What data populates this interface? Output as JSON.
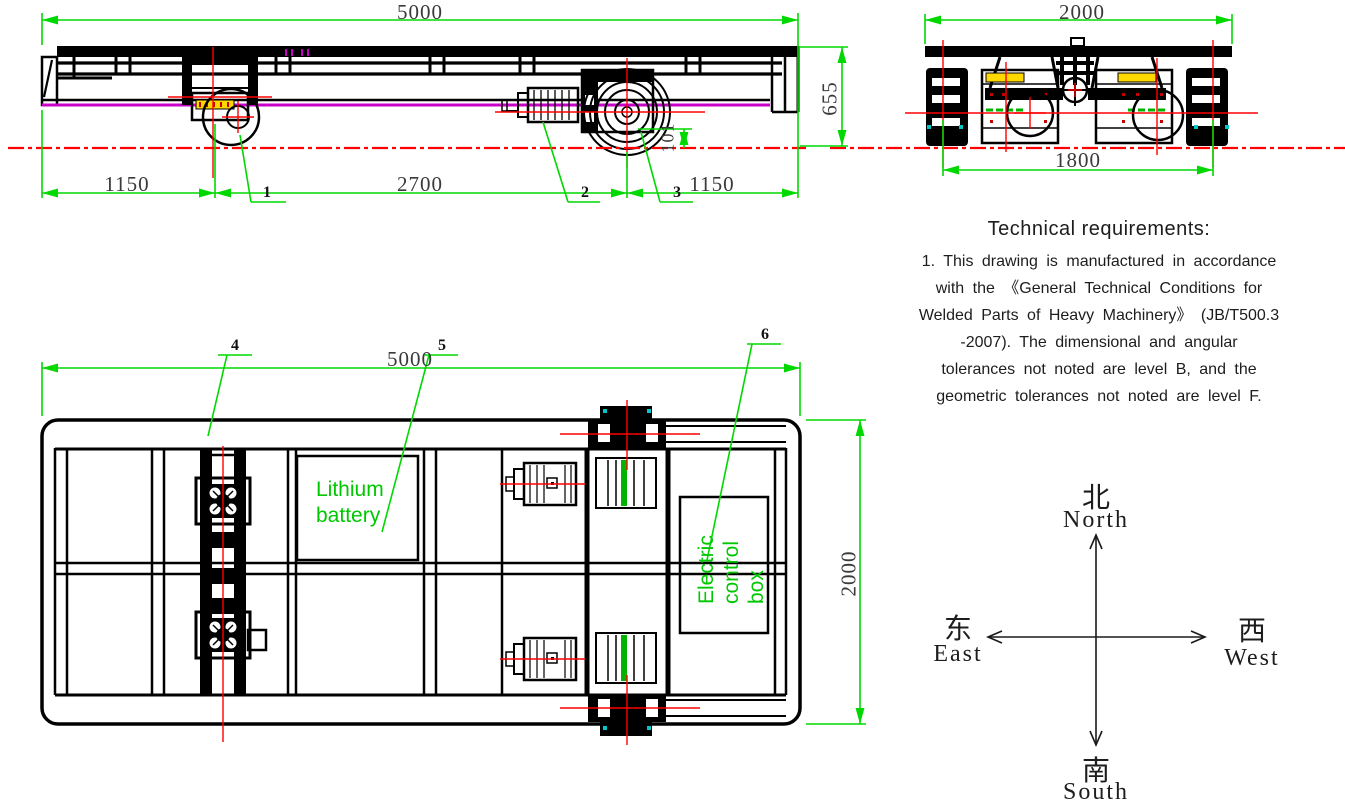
{
  "side_view": {
    "dim_total": "5000",
    "dim_left": "1150",
    "dim_center": "2700",
    "dim_right": "1150",
    "dim_height": "655",
    "dim_wheel_rail": "101",
    "callout_1": "1",
    "callout_2": "2",
    "callout_3": "3"
  },
  "end_view": {
    "dim_width": "2000",
    "dim_gauge": "1800"
  },
  "plan_view": {
    "dim_length": "5000",
    "dim_width": "2000",
    "callout_4": "4",
    "callout_5": "5",
    "callout_6": "6",
    "battery_line1": "Lithium",
    "battery_line2": "battery",
    "control_line1": "Electric",
    "control_line2": "control",
    "control_line3": "box"
  },
  "tech_requirements": {
    "title": "Technical requirements:",
    "lines": [
      "1. This drawing is manufactured in accordance",
      "with the 《General Technical Conditions for",
      "Welded Parts of Heavy Machinery》 (JB/T500.3",
      "-2007). The dimensional and angular",
      "tolerances not noted are level B, and the",
      "geometric tolerances not noted are level F."
    ]
  },
  "compass": {
    "north_cn": "北",
    "north_en": "North",
    "south_cn": "南",
    "south_en": "South",
    "east_cn": "东",
    "east_en": "East",
    "west_cn": "西",
    "west_en": "West"
  },
  "colors": {
    "dimension_green": "#00d800",
    "centerline_red": "#ff0000",
    "frame_magenta": "#c800c8",
    "nameplate_yellow": "#ffd800",
    "shaft_green": "#00b400",
    "mark_cyan": "#00c8c8"
  }
}
